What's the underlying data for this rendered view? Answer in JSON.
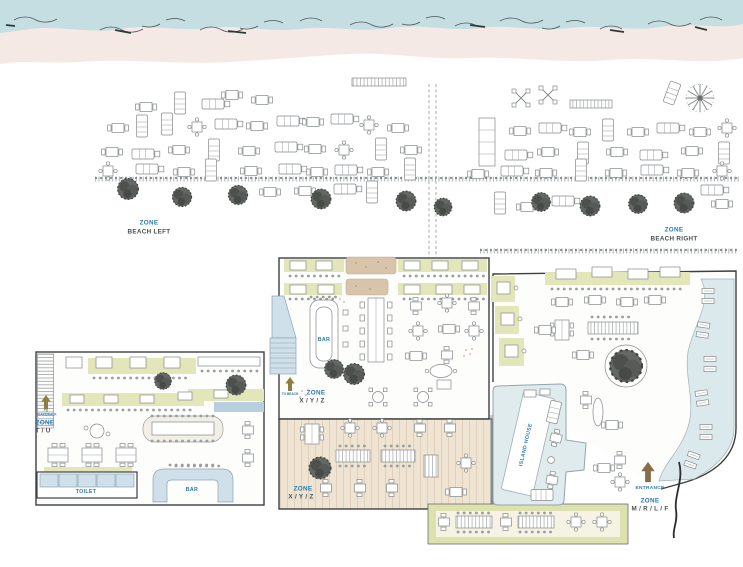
{
  "zones": {
    "beach_left": {
      "zone": "ZONE",
      "name": "BEACH LEFT"
    },
    "beach_right": {
      "zone": "ZONE",
      "name": "BEACH RIGHT"
    },
    "indoor": {
      "zone": "ZONE",
      "name": "X / Y / Z",
      "direction": "TO BEACH"
    },
    "tu": {
      "zone": "ZONE",
      "name": "T / U",
      "direction": "TO BOARDWALK"
    },
    "terrace": {
      "zone": "ZONE",
      "name": "X / Y / Z"
    },
    "mrlf": {
      "zone": "ZONE",
      "name": "M / R / L / F",
      "entrance": "ENTRANCE"
    }
  },
  "facilities": {
    "toilet": "TOILET",
    "bar_left": "BAR",
    "bar_indoor": "BAR",
    "pool_building": "ISLAND HOUSE"
  },
  "icons": {
    "tree": "tree-icon",
    "palm": "palm-tree-icon",
    "up_arrow": "up-arrow-icon",
    "entrance_arrow": "entrance-arrow-icon"
  },
  "colors": {
    "water": "#c5dee2",
    "sand": "#f4e9e4",
    "olive_bench": "#e3e6b8",
    "tan_planter": "#d7c4ab",
    "light_blue": "#cfe0ea",
    "pool": "#e0ebee",
    "deck": "#efe3d2",
    "label_blue": "#2b79ad",
    "label_dark": "#4b4f52",
    "arrow_olive": "#8f7d3e",
    "arrow_brown": "#8a6b4a"
  }
}
